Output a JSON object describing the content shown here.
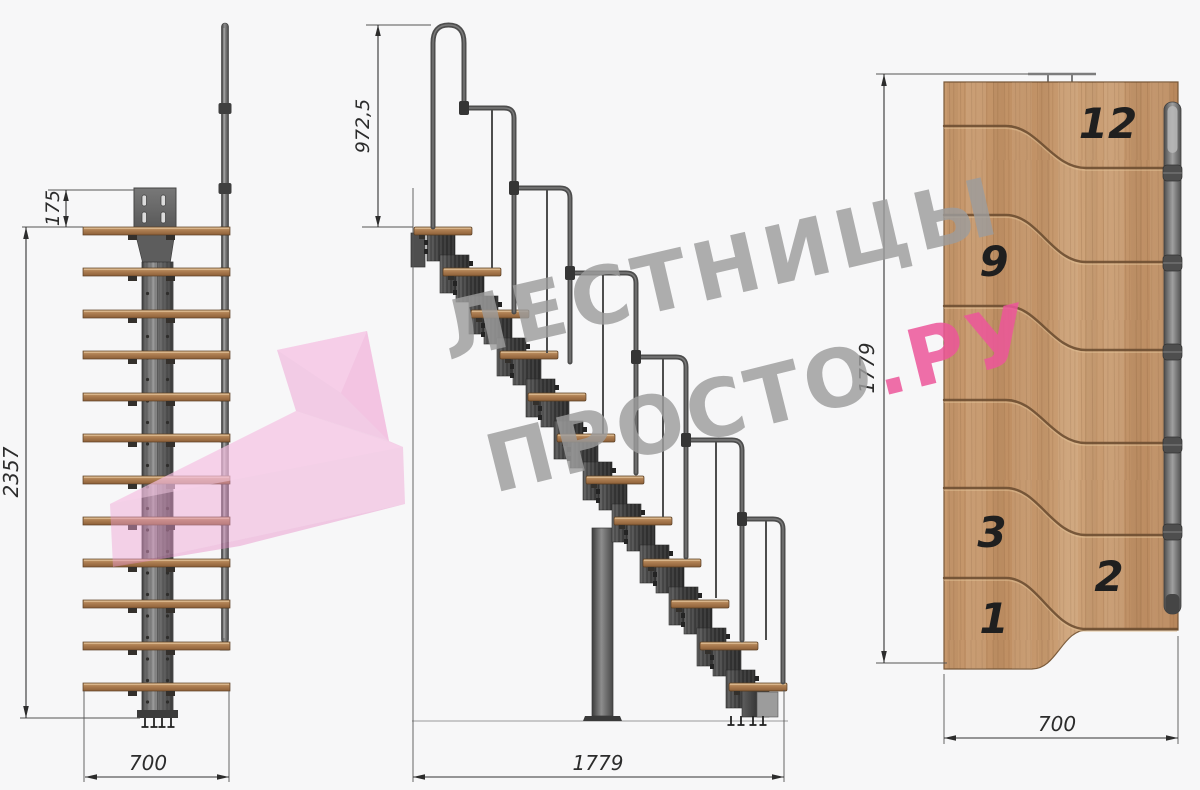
{
  "watermark": {
    "line1": "ЛЕСТНИЦЫ",
    "line2": "ПРОСТО",
    "suffix": ".РУ"
  },
  "front_view": {
    "dim_plate_offset": "175",
    "dim_height": "2357",
    "dim_width": "700"
  },
  "side_view": {
    "dim_rail_height": "972,5",
    "dim_run": "1779"
  },
  "plan_view": {
    "dim_run": "1779",
    "dim_width": "700",
    "step_numbers": [
      "12",
      "9",
      "3",
      "2",
      "1"
    ]
  },
  "colors": {
    "background": "#f7f7f8",
    "wood": "#c49468",
    "metal_dark": "#4d4d4d",
    "dimension_ink": "#2c2c2c",
    "watermark_gray": "#9c9c9c",
    "accent_pink": "#ec569a",
    "logo_pink": "#eb92c8"
  }
}
